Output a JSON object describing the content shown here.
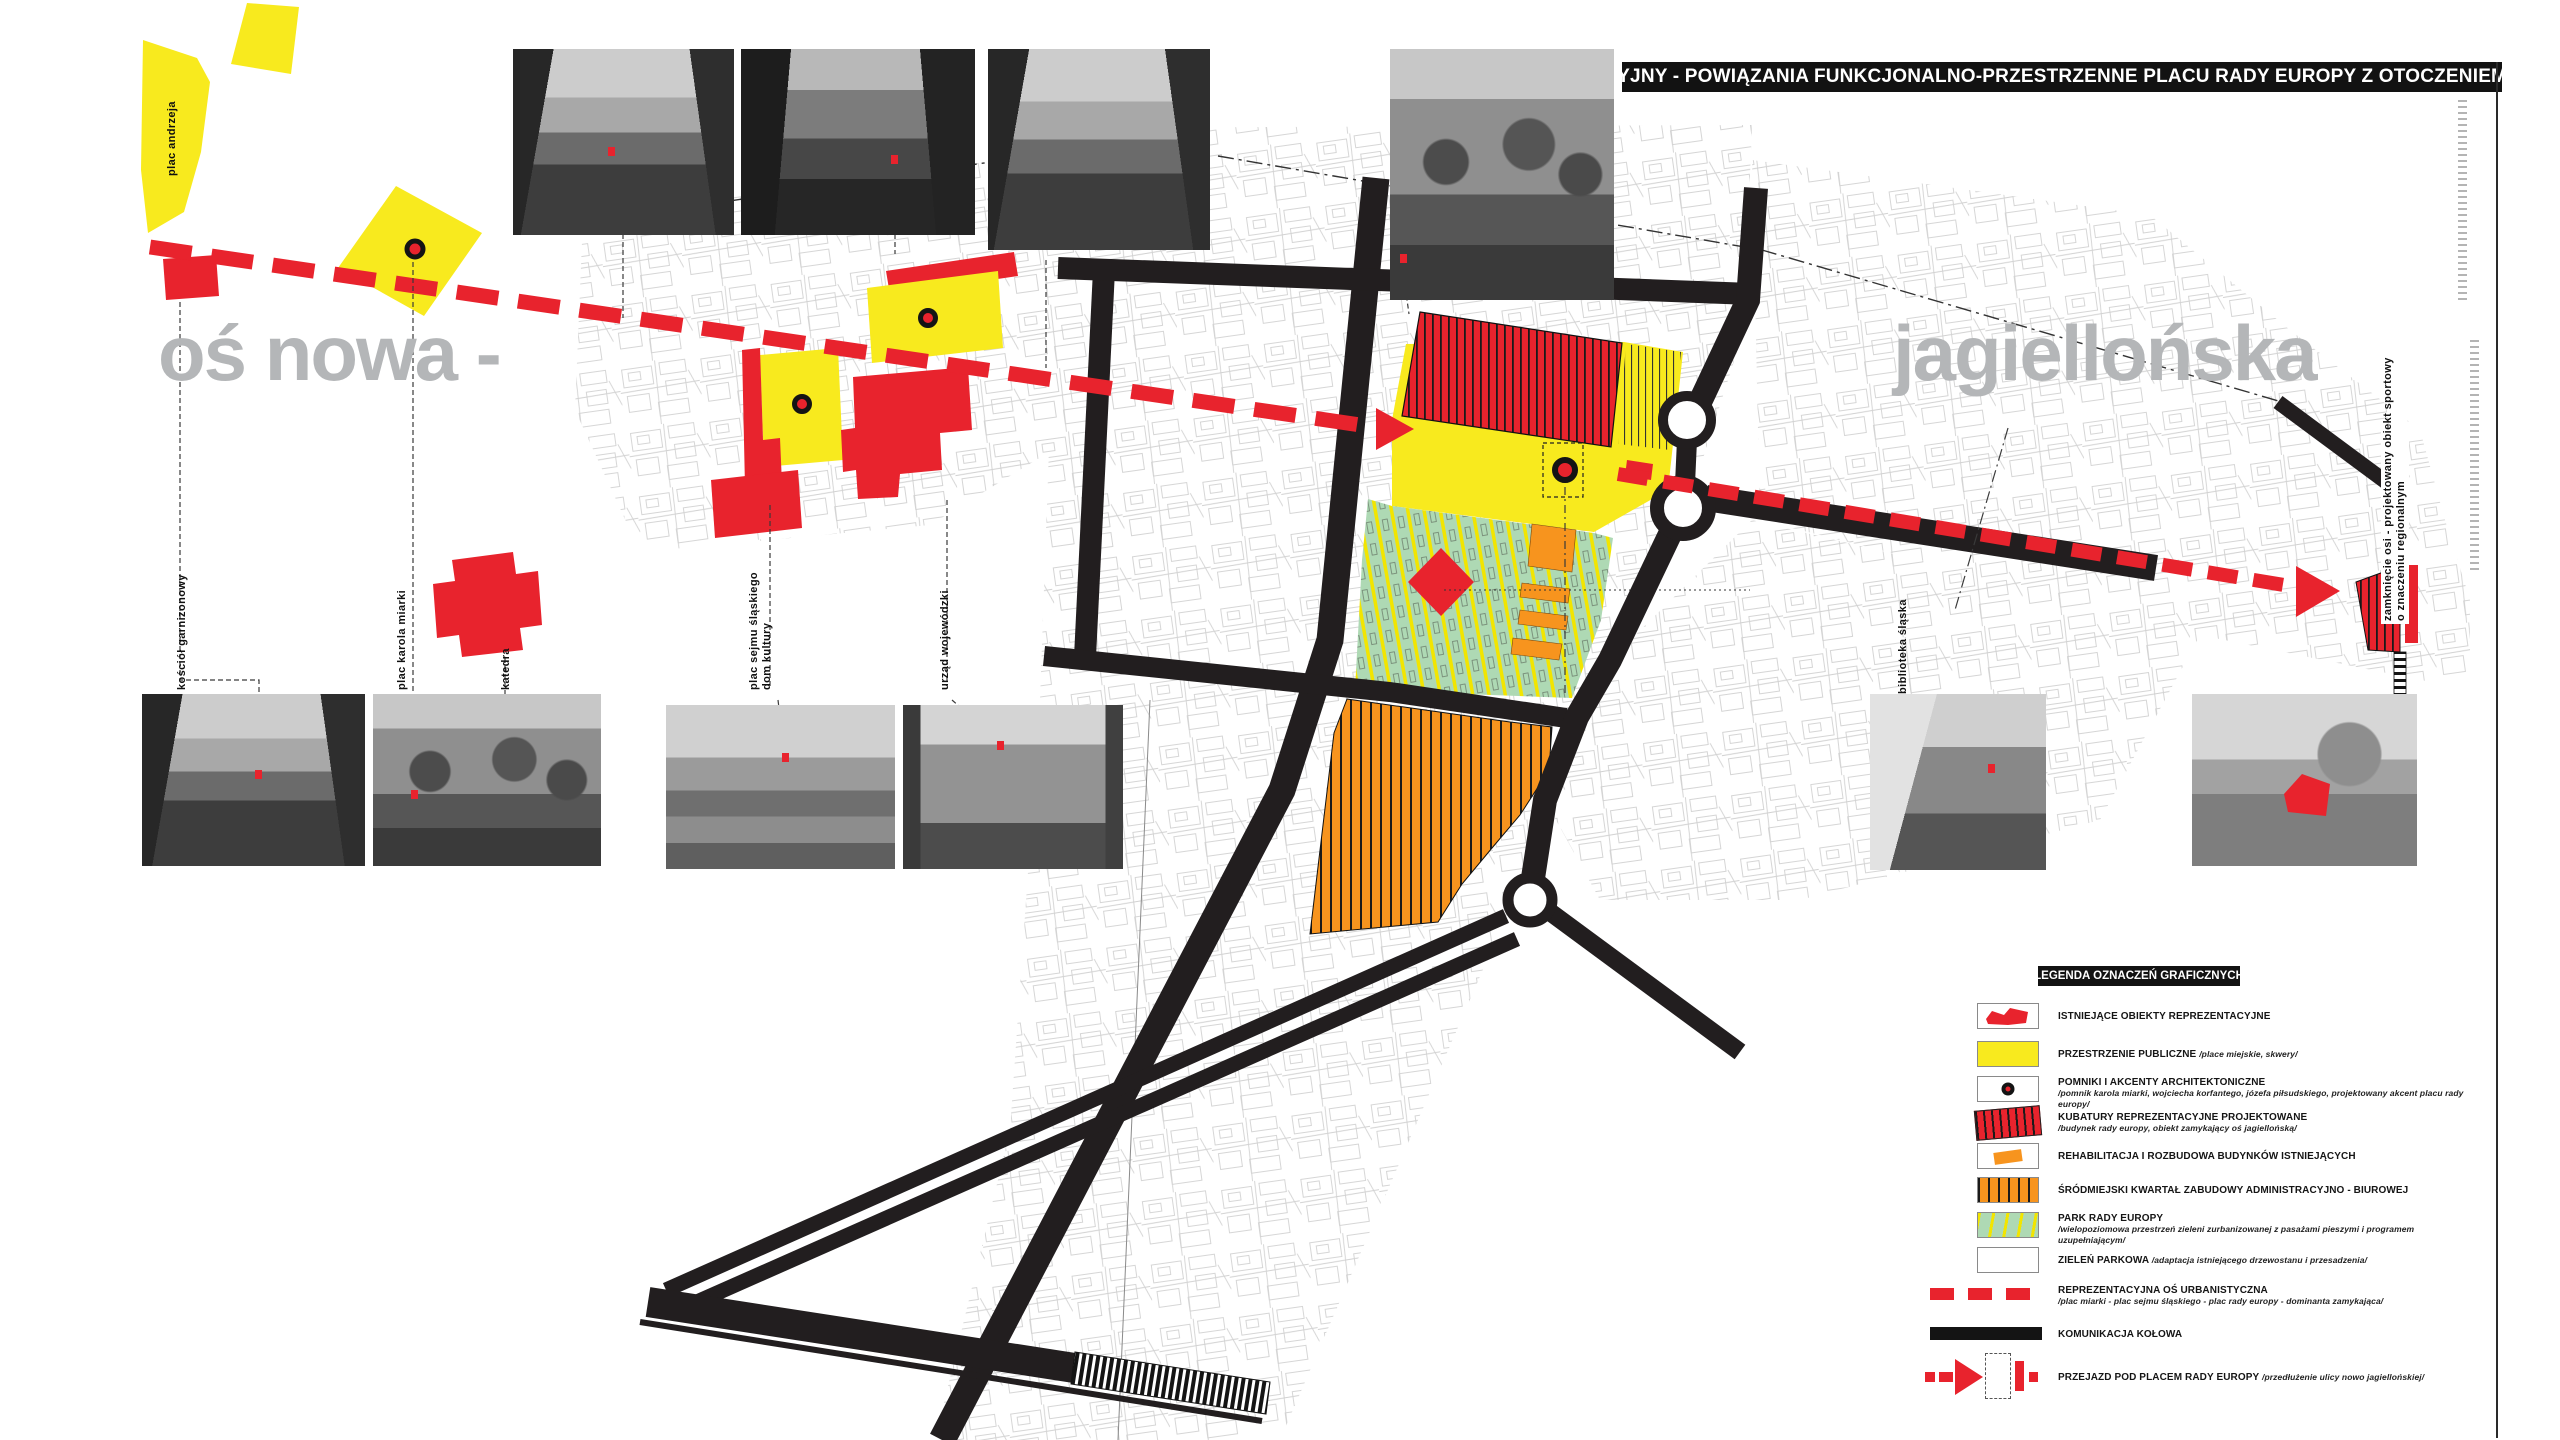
{
  "title_bar": {
    "text": "PLAN SYTUACYJNY - POWIĄZANIA FUNKCJONALNO-PRZESTRZENNE PLACU RADY EUROPY Z OTOCZENIEM  SKALA 1:2000"
  },
  "axis_labels": {
    "left": "oś nowa -",
    "right": "jagiellońska"
  },
  "map_labels": {
    "plac_andrzeja": "plac andrzeja",
    "kosciol_garnizonowy": "kościół garnizonowy",
    "plac_karola_miarki": "plac karola miarki",
    "katedra": "katedra",
    "plac_sejmu": "plac sejmu śląskiego\ndom kultury",
    "urzad_wojewodzki": "urząd wojewódzki",
    "biblioteka_slaska": "biblioteka śląska",
    "zamkniecie_osi": "zamknięcie osi - projektowany obiekt sportowy\no znaczeniu regionalnym"
  },
  "legend": {
    "header": "LEGENDA OZNACZEŃ GRAFICZNYCH",
    "items": [
      {
        "label": "ISTNIEJĄCE OBIEKTY REPREZENTACYJNE",
        "sub": ""
      },
      {
        "label": "PRZESTRZENIE PUBLICZNE",
        "sub": "/place miejskie, skwery/"
      },
      {
        "label": "POMNIKI I AKCENTY ARCHITEKTONICZNE",
        "sub": "/pomnik karola miarki, wojciecha korfantego, józefa piłsudskiego, projektowany akcent placu rady europy/"
      },
      {
        "label": "KUBATURY REPREZENTACYJNE PROJEKTOWANE",
        "sub": "/budynek rady europy, obiekt zamykający oś jagiellońską/"
      },
      {
        "label": "REHABILITACJA I ROZBUDOWA BUDYNKÓW ISTNIEJĄCYCH",
        "sub": ""
      },
      {
        "label": "ŚRÓDMIEJSKI KWARTAŁ ZABUDOWY ADMINISTRACYJNO - BIUROWEJ",
        "sub": ""
      },
      {
        "label": "PARK RADY EUROPY",
        "sub": "/wielopoziomowa przestrzeń zieleni zurbanizowanej z pasażami pieszymi i programem uzupełniającym/"
      },
      {
        "label": "ZIELEŃ PARKOWA",
        "sub": "/adaptacja istniejącego drzewostanu i przesadzenia/"
      },
      {
        "label": "REPREZENTACYJNA OŚ URBANISTYCZNA",
        "sub": "/plac miarki - plac sejmu śląskiego - plac rady europy - dominanta zamykająca/"
      },
      {
        "label": "KOMUNIKACJA KOŁOWA",
        "sub": ""
      },
      {
        "label": "PRZEJAZD POD PLACEM RADY EUROPY",
        "sub": "/przedłużenie ulicy nowo jagiellońskiej/"
      }
    ]
  },
  "colors": {
    "red": "#e8232d",
    "yellow": "#f8ea1e",
    "green": "#aed9b4",
    "stripe-yellow": "#f2e500",
    "orange": "#f7941e",
    "road": "#221e1f",
    "gray-text": "#b4b6b8",
    "map-line": "#999999"
  }
}
